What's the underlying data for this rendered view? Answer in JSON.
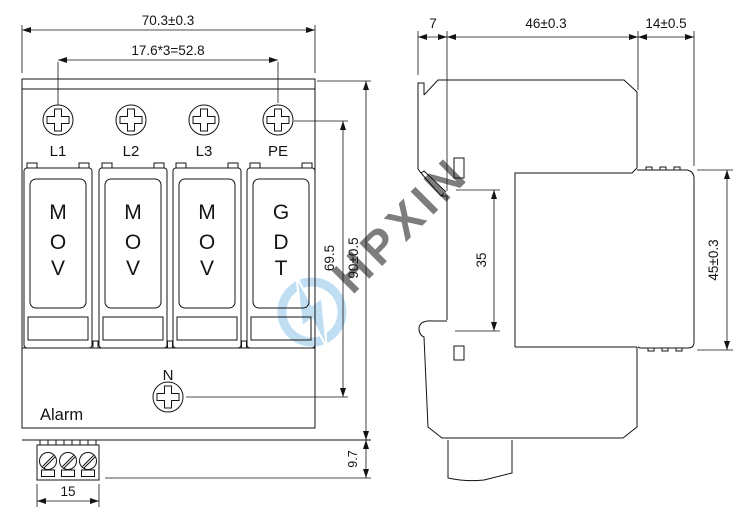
{
  "front_view": {
    "dims": {
      "overall_width": "70.3±0.3",
      "module_pitch": "17.6*3=52.8",
      "pe_to_n": "69.5",
      "overall_height": "90±0.5",
      "base_offset": "9.7",
      "terminal_width": "15"
    },
    "terminals": [
      "L1",
      "L2",
      "L3",
      "PE"
    ],
    "modules": [
      {
        "letters": [
          "M",
          "O",
          "V"
        ]
      },
      {
        "letters": [
          "M",
          "O",
          "V"
        ]
      },
      {
        "letters": [
          "M",
          "O",
          "V"
        ]
      },
      {
        "letters": [
          "G",
          "D",
          "T"
        ]
      }
    ],
    "neutral_label": "N",
    "alarm_label": "Alarm"
  },
  "side_view": {
    "dims": {
      "front_depth": "7",
      "body_depth": "46±0.3",
      "rear_depth": "14±0.5",
      "rail_width": "35",
      "rear_height": "45±0.3"
    }
  },
  "watermark": {
    "text": "HPXIN"
  },
  "colors": {
    "line": "#141414",
    "indicator_green": "#00e40a",
    "watermark_blue": "#8ec4e8",
    "background": "#ffffff"
  }
}
